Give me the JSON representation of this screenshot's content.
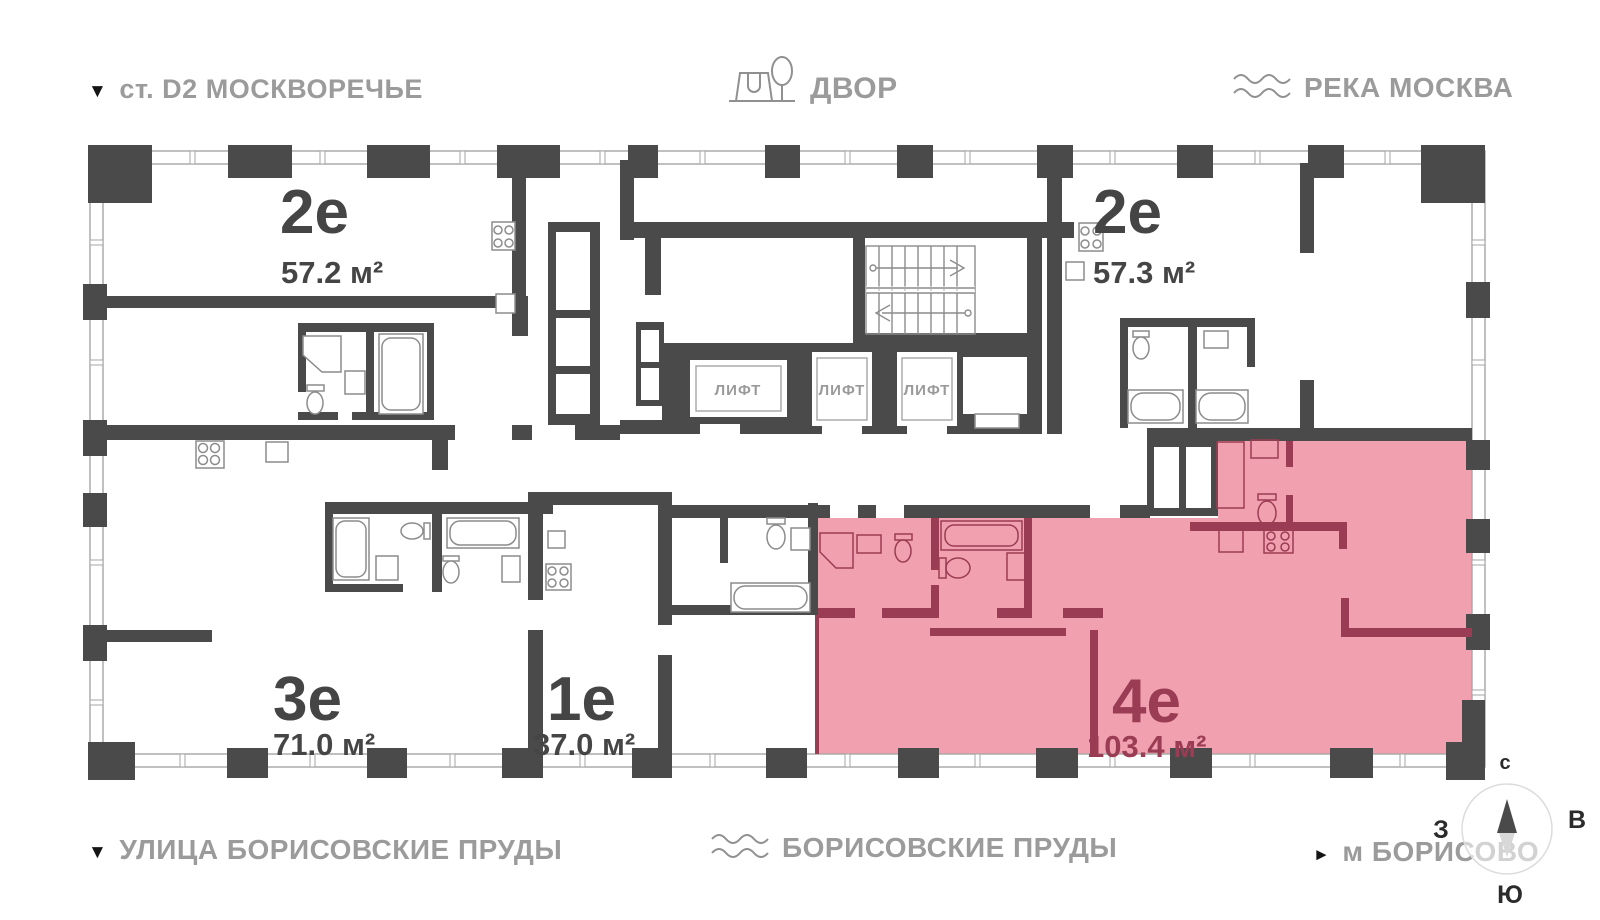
{
  "map_labels": {
    "station": {
      "marker": "▼",
      "text": "ст. D2 МОСКВОРЕЧЬЕ"
    },
    "courtyard": {
      "text": "ДВОР"
    },
    "river": {
      "text": "РЕКА МОСКВА"
    },
    "street": {
      "marker": "▼",
      "text": "УЛИЦА БОРИСОВСКИЕ ПРУДЫ"
    },
    "ponds": {
      "text": "БОРИСОВСКИЕ ПРУДЫ"
    },
    "metro": {
      "marker": "►",
      "text": "м БОРИСОВО"
    }
  },
  "apartments": [
    {
      "key": "2e-left",
      "id": "2е",
      "area": "57.2 м²",
      "highlighted": false
    },
    {
      "key": "2e-right",
      "id": "2е",
      "area": "57.3 м²",
      "highlighted": false
    },
    {
      "key": "3e",
      "id": "3е",
      "area": "71.0 м²",
      "highlighted": false
    },
    {
      "key": "1e",
      "id": "1е",
      "area": "37.0 м²",
      "highlighted": false
    },
    {
      "key": "4e",
      "id": "4е",
      "area": "103.4 м²",
      "highlighted": true
    }
  ],
  "elevator_label": "ЛИФТ",
  "compass": {
    "north": "с",
    "west": "З",
    "east": "В",
    "south": "Ю"
  },
  "colors": {
    "wall": "#4A4A4A",
    "highlight_fill": "#F1A0B0",
    "highlight_wall": "#9A3C53",
    "label_gray": "#9B9B9B",
    "fixture_gray": "#8C8C8C"
  }
}
